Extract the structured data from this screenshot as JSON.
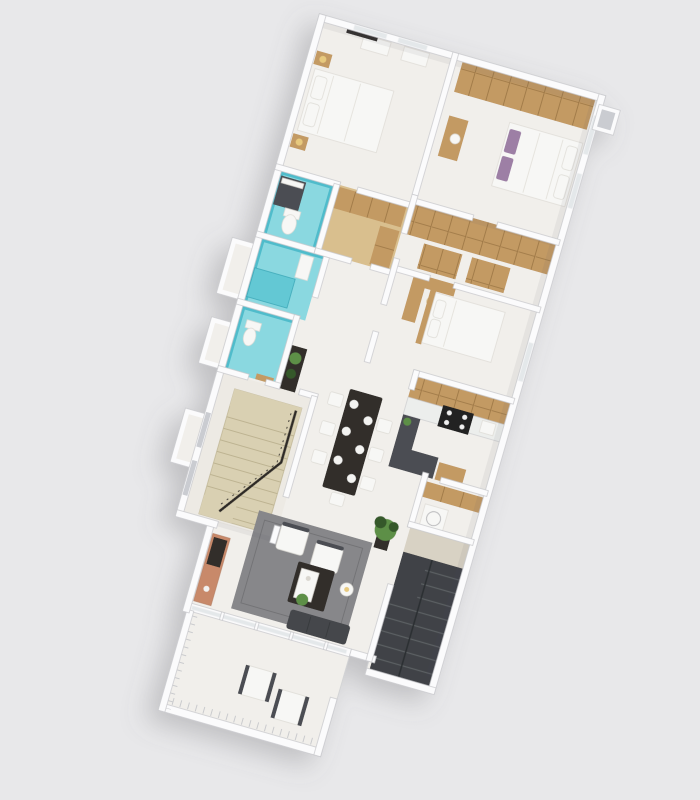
{
  "page": {
    "background": "#e8e8ea",
    "description": "Photorealistic 3D isometric top-down render of a single-storey apartment floor plan, rotated clockwise on a plain light gray backdrop; no visible text, labels or UI controls",
    "visible_text": []
  },
  "colors": {
    "bg": "#e8e8ea",
    "floor": "#f1efeb",
    "floorWarm": "#edeae4",
    "wallFill": "#fbfbfc",
    "wallEdge": "#c6c7ca",
    "wallShade": "#caccd1",
    "glass": "#e4e8ea",
    "glassFrame": "#f3f4f5",
    "tealFloor": "#8ad8e0",
    "tealWall": "#4fbccb",
    "tealMid": "#63c8d4",
    "tealDark": "#35a4b4",
    "wood": "#c39a63",
    "woodLight": "#d9bf8e",
    "woodDark": "#9a7443",
    "darkFurn": "#332f2c",
    "charcoal": "#4b4e53",
    "stove": "#212121",
    "white": "#f7f7f5",
    "rug": "#87878a",
    "rugDark": "#737376",
    "sofa": "#45474b",
    "terracotta": "#c8896a",
    "stairTan": "#d9d0b2",
    "stairLine": "#bdb391",
    "darkStairs": "#3f4246",
    "darkTread": "#5b5e63",
    "baluster": "#c9cacd",
    "plantGreen": "#5d8f46",
    "plantDark": "#35582a",
    "purple": "#9d7fa5",
    "lampWarm": "#e7c97e",
    "metal": "#b9b9bb",
    "railDark": "#2e2b28",
    "shadow": "#6b6b70"
  },
  "scene": {
    "type": "3d-floor-plan-render",
    "view": "isometric top-down, plan rotated ~16 degrees clockwise",
    "rooms": [
      {
        "name": "bedroom-1",
        "position": "top-left",
        "contents": [
          "double-bed-white",
          "two-wood-nightstands",
          "table-lamps",
          "wall-tv",
          "white-wardrobe-cabinets",
          "windows"
        ]
      },
      {
        "name": "bedroom-2",
        "position": "top-right",
        "contents": [
          "wood-wardrobe-wall",
          "double-bed-purple-pillows",
          "wood-dresser-with-mirror",
          "windows"
        ]
      },
      {
        "name": "bathroom-1",
        "position": "mid-left",
        "contents": [
          "teal-tile-floor",
          "dark-shower-box",
          "white-toilet"
        ]
      },
      {
        "name": "walk-in-closet",
        "position": "middle",
        "contents": [
          "wood-floor",
          "wood-shelving"
        ]
      },
      {
        "name": "bathroom-2",
        "position": "mid-left-lower",
        "contents": [
          "teal-tile-floor",
          "teal-bathtub",
          "white-vanity"
        ]
      },
      {
        "name": "dressing-room",
        "position": "mid-right",
        "contents": [
          "open-wood-wardrobes"
        ]
      },
      {
        "name": "bedroom-3",
        "position": "center-right",
        "contents": [
          "double-bed-white",
          "wood-corner-desk"
        ]
      },
      {
        "name": "powder-room",
        "position": "center-left",
        "contents": [
          "teal-tile-floor",
          "white-toilet",
          "wood-door"
        ]
      },
      {
        "name": "dining-area",
        "position": "center",
        "contents": [
          "black-dining-table",
          "seven-white-chairs",
          "white-plates",
          "dark-console-with-plants"
        ]
      },
      {
        "name": "kitchen",
        "position": "center-right",
        "contents": [
          "wood-upper-cabinets",
          "marble-counter",
          "black-stove",
          "charcoal-peninsula",
          "wood-base-cabinet"
        ]
      },
      {
        "name": "laundry",
        "position": "right",
        "contents": [
          "wood-shelf",
          "white-washer"
        ]
      },
      {
        "name": "stair-room",
        "position": "lower-left",
        "contents": [
          "tan-stone-staircase",
          "dark-metal-railing"
        ]
      },
      {
        "name": "living-room",
        "position": "lower-center",
        "contents": [
          "gray-rug",
          "two-white-armchairs",
          "dark-sofa",
          "dark-coffee-table-with-plant",
          "terracotta-sideboard",
          "tall-potted-plant",
          "floor-lamp",
          "glass-wall"
        ]
      },
      {
        "name": "exit-staircase",
        "position": "lower-right",
        "contents": [
          "charcoal-steps",
          "beige-landing"
        ]
      },
      {
        "name": "balcony",
        "position": "bottom",
        "contents": [
          "white-railing-with-balusters",
          "two-white-lounge-chairs"
        ]
      }
    ],
    "exterior": [
      "three-white-utility-shafts-left-side",
      "small-duct-box-top-right",
      "soft-drop-shadow-lower-left"
    ]
  }
}
